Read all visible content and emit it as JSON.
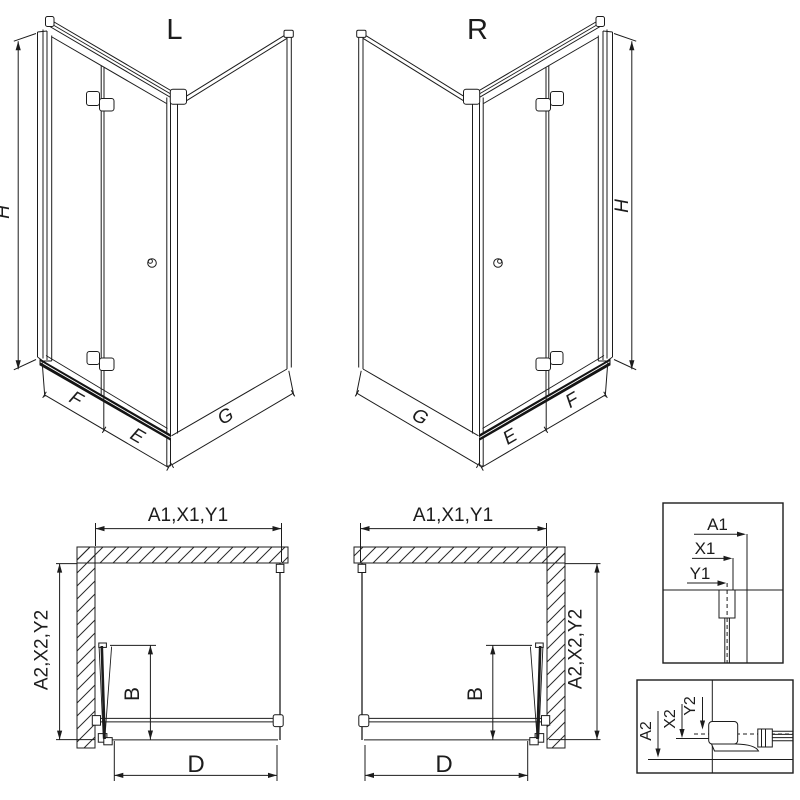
{
  "drawing": {
    "background": "#ffffff",
    "line_color": "#1c1c1c",
    "views": {
      "iso_left": {
        "title": "L",
        "labels": {
          "height": "H",
          "door_leaf_wall": "F",
          "door_leaf_corner": "E",
          "side_wall": "G"
        }
      },
      "iso_right": {
        "title": "R",
        "labels": {
          "height": "H",
          "door_leaf_wall": "F",
          "door_leaf_corner": "E",
          "side_wall": "G"
        }
      },
      "plan_left": {
        "labels": {
          "front_width": "A1,X1,Y1",
          "side_depth": "A2,X2,Y2",
          "door_projection": "B",
          "entry_width": "D"
        }
      },
      "plan_right": {
        "labels": {
          "front_width": "A1,X1,Y1",
          "side_depth": "A2,X2,Y2",
          "door_projection": "B",
          "entry_width": "D"
        }
      },
      "detail_width": {
        "labels": [
          "A1",
          "X1",
          "Y1"
        ]
      },
      "detail_depth": {
        "labels": [
          "A2",
          "X2",
          "Y2"
        ]
      }
    }
  }
}
